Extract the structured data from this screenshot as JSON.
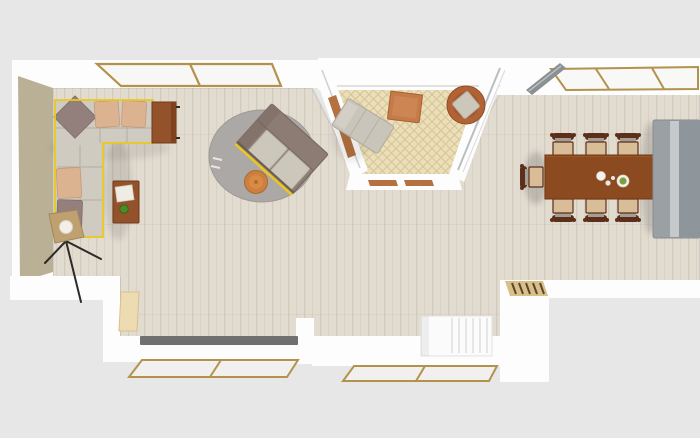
{
  "palette": {
    "background": "#e7e7e7",
    "wall": "#fdfdfd",
    "accent_wall": "#b9b096",
    "floor_base": "#e1dbd0",
    "floor_grain": "#b7a992",
    "balcony_tile": "#ebdfba",
    "balcony_tile_line": "#d8c596",
    "window_frame": "#b2924d",
    "glass": "#f6f6f4",
    "open_leaf_gray": "#8b9093",
    "selection_yellow": "#eac81f",
    "sofa_body": "#cfcbc0",
    "pillow_tan": "#dcb391",
    "pillow_mauve": "#937f7b",
    "wood_rust": "#94522a",
    "table_brown": "#8c4a20",
    "rug_gray": "#aca8a5",
    "loveseat_brown": "#8d7c73",
    "cushion_light": "#ccc7bb",
    "pouf_orange": "#cd803e",
    "chaise_gray": "#c9c5ba",
    "ottoman_terracotta": "#c57a48",
    "armchair_rust": "#b16336",
    "chair_frame": "#5c2f1a",
    "chair_seat": "#d8bd98",
    "chair_back": "#a59c93",
    "kitchen_unit": "#9ba0a4",
    "kitchen_unit_light": "#c6c9cb",
    "kitchen_unit_dark": "#8f969b",
    "radiator_gray": "#707070",
    "door_panel": "#eddbb2",
    "doormat": "#d9bf8a",
    "doormat_dash": "#57492a",
    "stair_white": "#fbfbfb",
    "lamp_black": "#2e2a26",
    "lamp_shade": "#bfa071",
    "plate_white": "#f4f2ee",
    "salad_green": "#79a03a",
    "apple_green": "#4a8c2a",
    "terracotta_strip": "#b5713f"
  },
  "rooms": [
    {
      "id": "living-room",
      "label": "Living room"
    },
    {
      "id": "balcony-nook",
      "label": "Balcony nook"
    },
    {
      "id": "dining-area",
      "label": "Dining area"
    },
    {
      "id": "stair-hall",
      "label": "Staircase"
    }
  ],
  "furniture": {
    "corner_sofa": "Corner sofa (selected)",
    "sideboard": "Sideboard",
    "coffee_table": "Coffee table",
    "floor_lamp": "Tripod floor lamp",
    "round_rug": "Round rug",
    "loveseat": "Two-seat sofa (selected)",
    "pouf": "Round pouf",
    "chaise_lounge": "Chaise lounge",
    "ottoman": "Square ottoman",
    "armchair": "Round armchair",
    "dining_table": "Dining table",
    "dining_chair": "Dining chair",
    "kitchen_unit": "Kitchen cabinet",
    "staircase": "Staircase",
    "doormat": "Entry mat",
    "door": "Door",
    "radiator": "Radiator",
    "window": "Window",
    "open_window": "Open window leaf",
    "accent_wall": "Accent wall"
  }
}
